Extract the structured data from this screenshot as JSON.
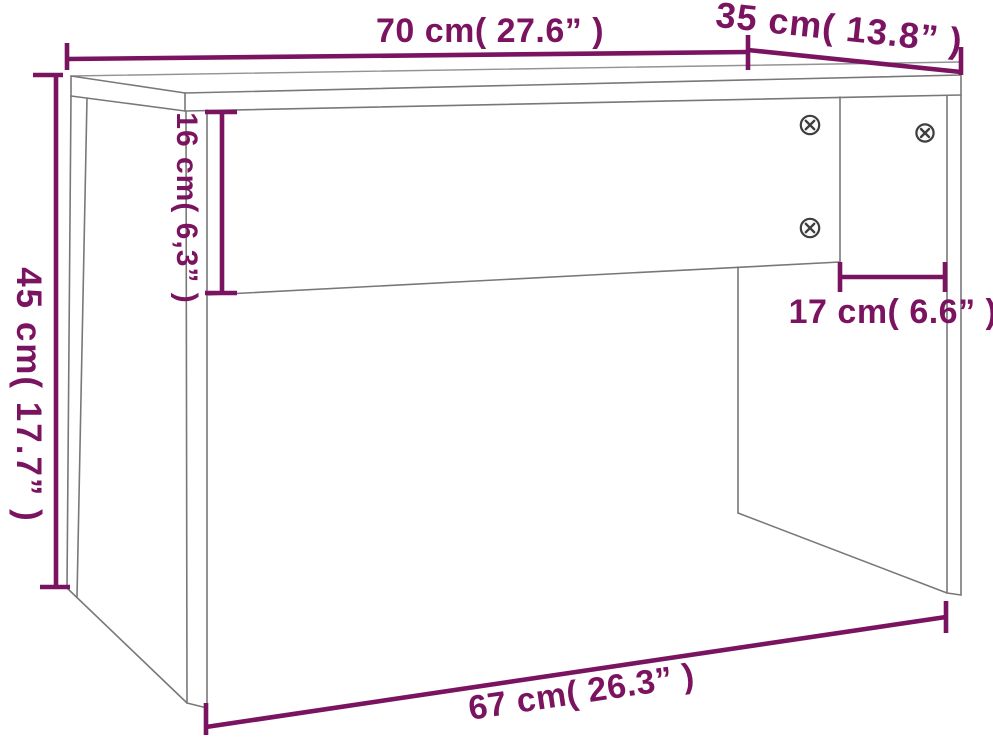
{
  "diagram": {
    "type": "furniture-dimension-drawing",
    "subject": "stool",
    "dimensions": {
      "top_width": {
        "label": "70 cm( 27.6” )"
      },
      "top_depth": {
        "label": "35 cm( 13.8” )"
      },
      "height": {
        "label": "45 cm( 17.7” )"
      },
      "apron_height": {
        "label": "16 cm( 6,3” )"
      },
      "side_offset": {
        "label": "17 cm( 6.6” )"
      },
      "base_width": {
        "label": "67 cm( 26.3” )"
      }
    },
    "colors": {
      "dimension": "#7b1460",
      "outline": "#787878",
      "screw": "#3d3d3d",
      "background": "#ffffff"
    }
  }
}
